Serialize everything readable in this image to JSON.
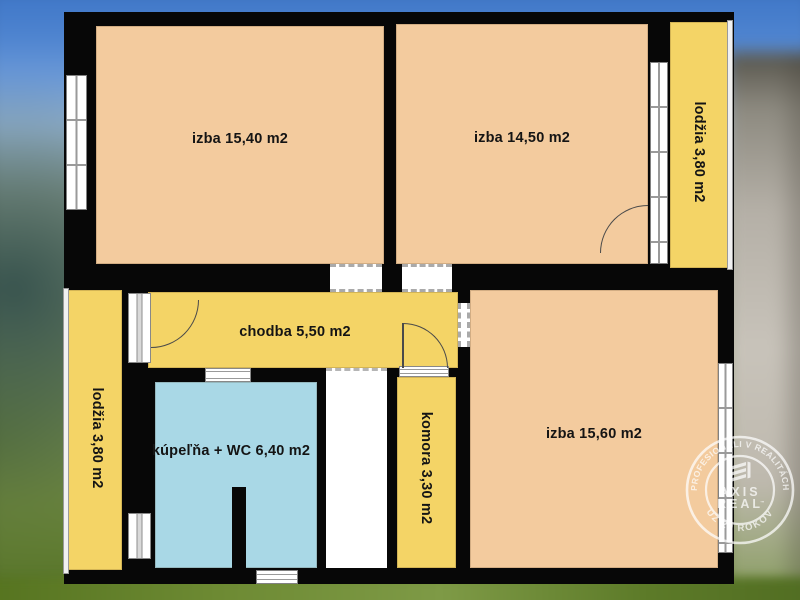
{
  "plan": {
    "rooms": [
      {
        "id": "izba-1540",
        "label": "izba 15,40 m2"
      },
      {
        "id": "izba-1450",
        "label": "izba 14,50 m2"
      },
      {
        "id": "lodzia-right",
        "label": "lodžia 3,80 m2"
      },
      {
        "id": "chodba",
        "label": "chodba 5,50 m2"
      },
      {
        "id": "lodzia-left",
        "label": "lodžia 3,80 m2"
      },
      {
        "id": "kupelna-wc",
        "label": "kúpeľňa + WC 6,40 m2"
      },
      {
        "id": "komora",
        "label": "komora 3,30 m2"
      },
      {
        "id": "izba-1560",
        "label": "izba 15,60 m2"
      }
    ],
    "colors": {
      "room_peach": "#f3cb9e",
      "zone_yellow": "#f4d466",
      "bath_blue": "#a9d8e6",
      "wall_black": "#070707",
      "label_color": "#141414"
    }
  },
  "watermark": {
    "arc_top": "PROFESIONÁLI V REALITÁCH",
    "arc_bottom": "UŽ 20 ROKOV",
    "brand_top": "AXIS",
    "brand_bottom": "REAL",
    "trademark": "™"
  }
}
